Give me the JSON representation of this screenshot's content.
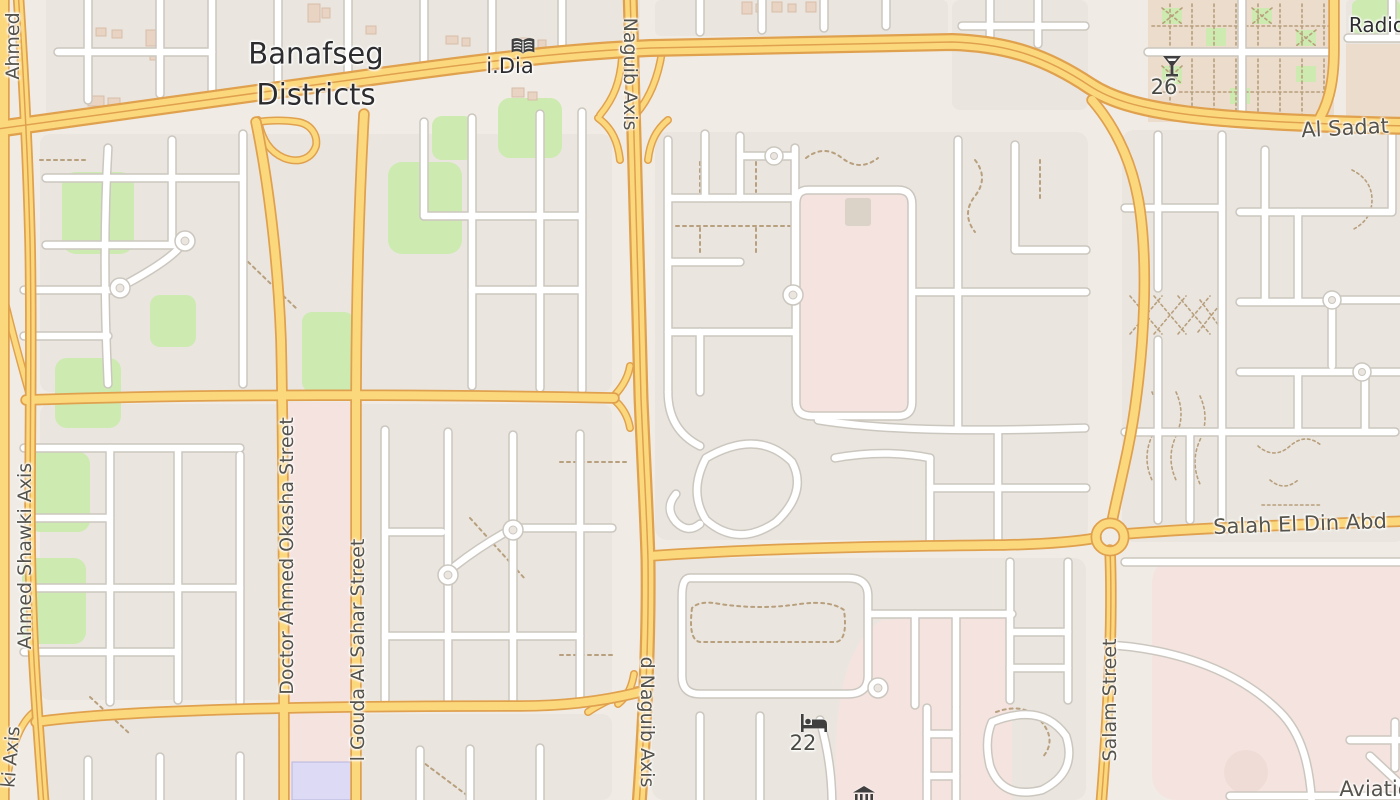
{
  "map": {
    "place_labels": {
      "district": "Banafseg Districts"
    },
    "street_labels": {
      "ahmed": "Ahmed",
      "naguib_top": "Naguib Axis",
      "naguib_bottom": "d Naguib Axis",
      "al_sadat": "Al Sadat",
      "ahmed_shawki": "Ahmed Shawki Axis",
      "ki_axis": "ki Axis",
      "okasha": "Doctor Ahmed Okasha Street",
      "gouda": "l Gouda Al Sahar Street",
      "salah_el_din": "Salah El Din Abd",
      "salam": "Salam Street",
      "aviation": "Aviatio",
      "radio": "Radio"
    },
    "pois": {
      "library": {
        "label": "i.Dia",
        "icon": "open-book"
      },
      "bar": {
        "label": "26",
        "icon": "cocktail-glass"
      },
      "hotel": {
        "label": "22",
        "icon": "bed"
      },
      "museum": {
        "label": "",
        "icon": "classical-building"
      }
    },
    "colors": {
      "land": "#f0ece5",
      "block": "#eae6df",
      "green": "#cdeab0",
      "pink": "#f5e3df",
      "parcel": "#ecdccb",
      "lavender": "#dcdaf4",
      "building": "#e9d4c4",
      "road_fill": "#fcd87d",
      "road_casing": "#e0a14f",
      "street_fill": "#ffffff",
      "street_casing": "#cbc7bf",
      "path_dash": "#b89f7d",
      "label": "#55534b",
      "place_label": "#2c2c2f",
      "icon": "#3f3f3f"
    }
  }
}
